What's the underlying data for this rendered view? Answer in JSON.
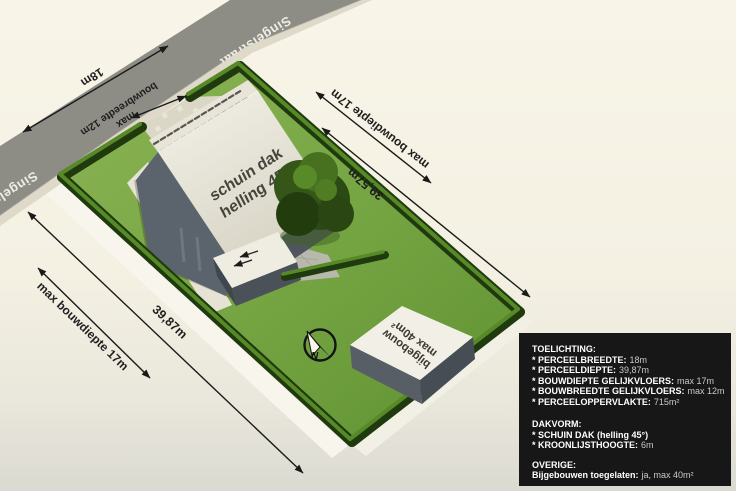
{
  "scene": {
    "street": {
      "name": "Singelstraat"
    },
    "roof": {
      "line1": "schuin dak",
      "line2": "helling 45°"
    },
    "outbuilding": {
      "line1": "bijgebouw",
      "line2": "max 40m²"
    },
    "compass": {
      "north": "N"
    },
    "dimensions": {
      "frontage": "18m",
      "build_width_l1": "max",
      "build_width_l2": "bouwbreedte 12m",
      "build_depth_right": "max bouwdiepte 17m",
      "plot_depth_right": "39,57m",
      "build_depth_left": "max bouwdiepte 17m",
      "plot_depth_left": "39,87m"
    }
  },
  "legend": {
    "sections": [
      {
        "title": "TOELICHTING:",
        "items": [
          {
            "label": "* PERCEELBREEDTE:",
            "value": "18m"
          },
          {
            "label": "* PERCEELDIEPTE:",
            "value": "39,87m"
          },
          {
            "label": "* BOUWDIEPTE GELIJKVLOERS:",
            "value": "max 17m"
          },
          {
            "label": "* BOUWBREEDTE GELIJKVLOERS:",
            "value": "max 12m"
          },
          {
            "label": "* PERCEELOPPERVLAKTE:",
            "value": "715m²"
          }
        ]
      },
      {
        "title": "DAKVORM:",
        "items": [
          {
            "label": "* SCHUIN DAK (helling 45°)",
            "value": ""
          },
          {
            "label": "* KROONLIJSTHOOGTE:",
            "value": "6m"
          }
        ]
      },
      {
        "title": "OVERIGE:",
        "items": [
          {
            "label": "Bijgebouwen toegelaten:",
            "value": "ja, max 40m²"
          }
        ]
      }
    ]
  },
  "colors": {
    "background": "#f6f3e6",
    "road": "#8d8d86",
    "grass_light": "#8ab254",
    "grass_dark": "#649232",
    "hedge_dark": "#1f3a0e",
    "hedge_light": "#578a27",
    "roof_white": "#ece9dc",
    "wall_gray": "#59616b",
    "arrow": "#1a1a1a",
    "legend_bg": "#171717",
    "street_text": "#efeee6"
  }
}
